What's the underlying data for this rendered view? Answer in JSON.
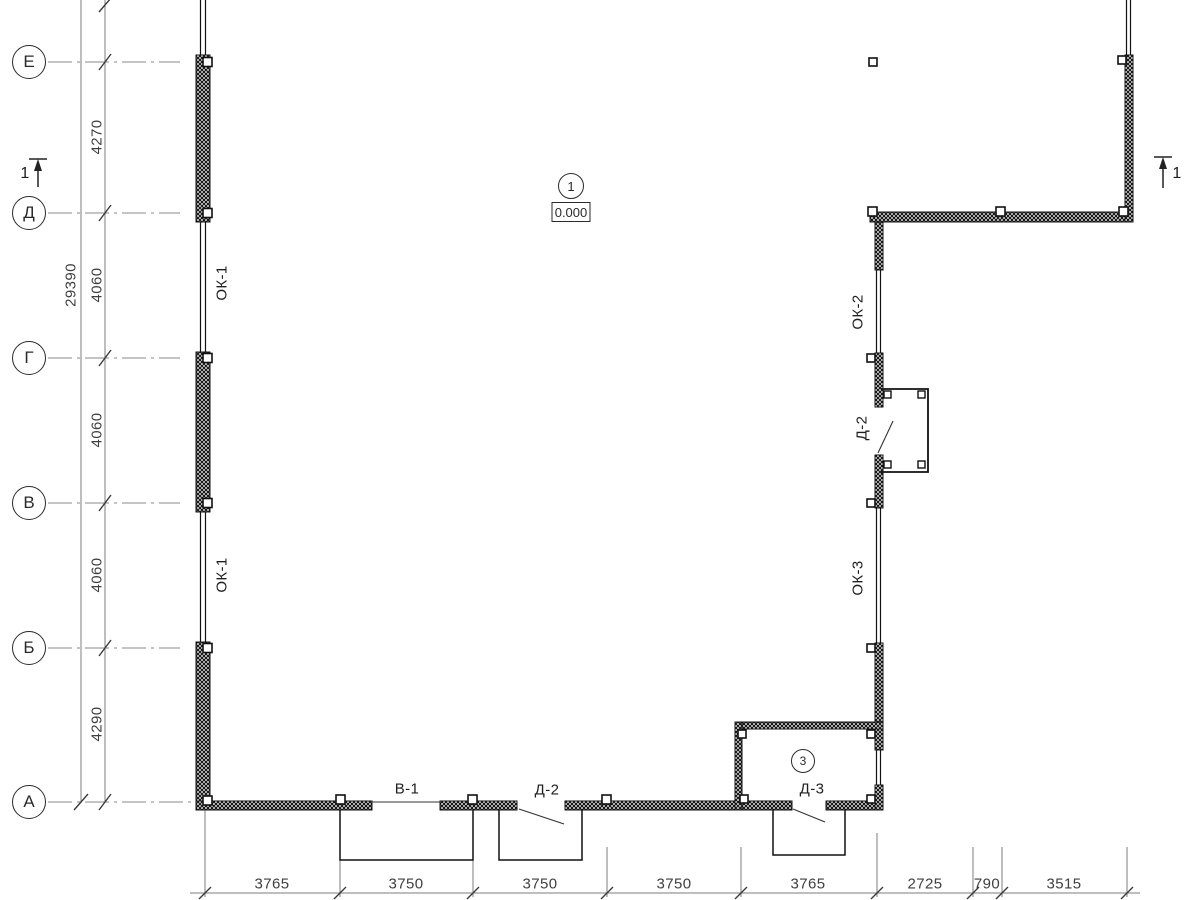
{
  "colors": {
    "line": "#1a1a1a",
    "axis_line": "#8a8a8a",
    "dim_text": "#4f4f4f"
  },
  "axes": {
    "rows": [
      {
        "label": "Е"
      },
      {
        "label": "Д"
      },
      {
        "label": "Г"
      },
      {
        "label": "В"
      },
      {
        "label": "Б"
      },
      {
        "label": "А"
      }
    ]
  },
  "dims": {
    "vertical_overall": "29390",
    "vertical": [
      "4270",
      "4060",
      "4060",
      "4060",
      "4290"
    ],
    "bottom": [
      "3765",
      "3750",
      "3750",
      "3750",
      "3765",
      "2725",
      "790",
      "3515"
    ]
  },
  "labels": {
    "windows": {
      "ok1_upper": "ОК-1",
      "ok1_lower": "ОК-1",
      "ok2": "ОК-2",
      "ok3": "ОК-3"
    },
    "doors": {
      "d2_side": "Д-2",
      "v1_bottom": "В-1",
      "d2_bottom": "Д-2",
      "d3_bottom": "Д-3"
    }
  },
  "markers": {
    "node_1": "1",
    "elevation": "0.000",
    "node_3": "3",
    "section_left": "1",
    "section_right": "1"
  }
}
